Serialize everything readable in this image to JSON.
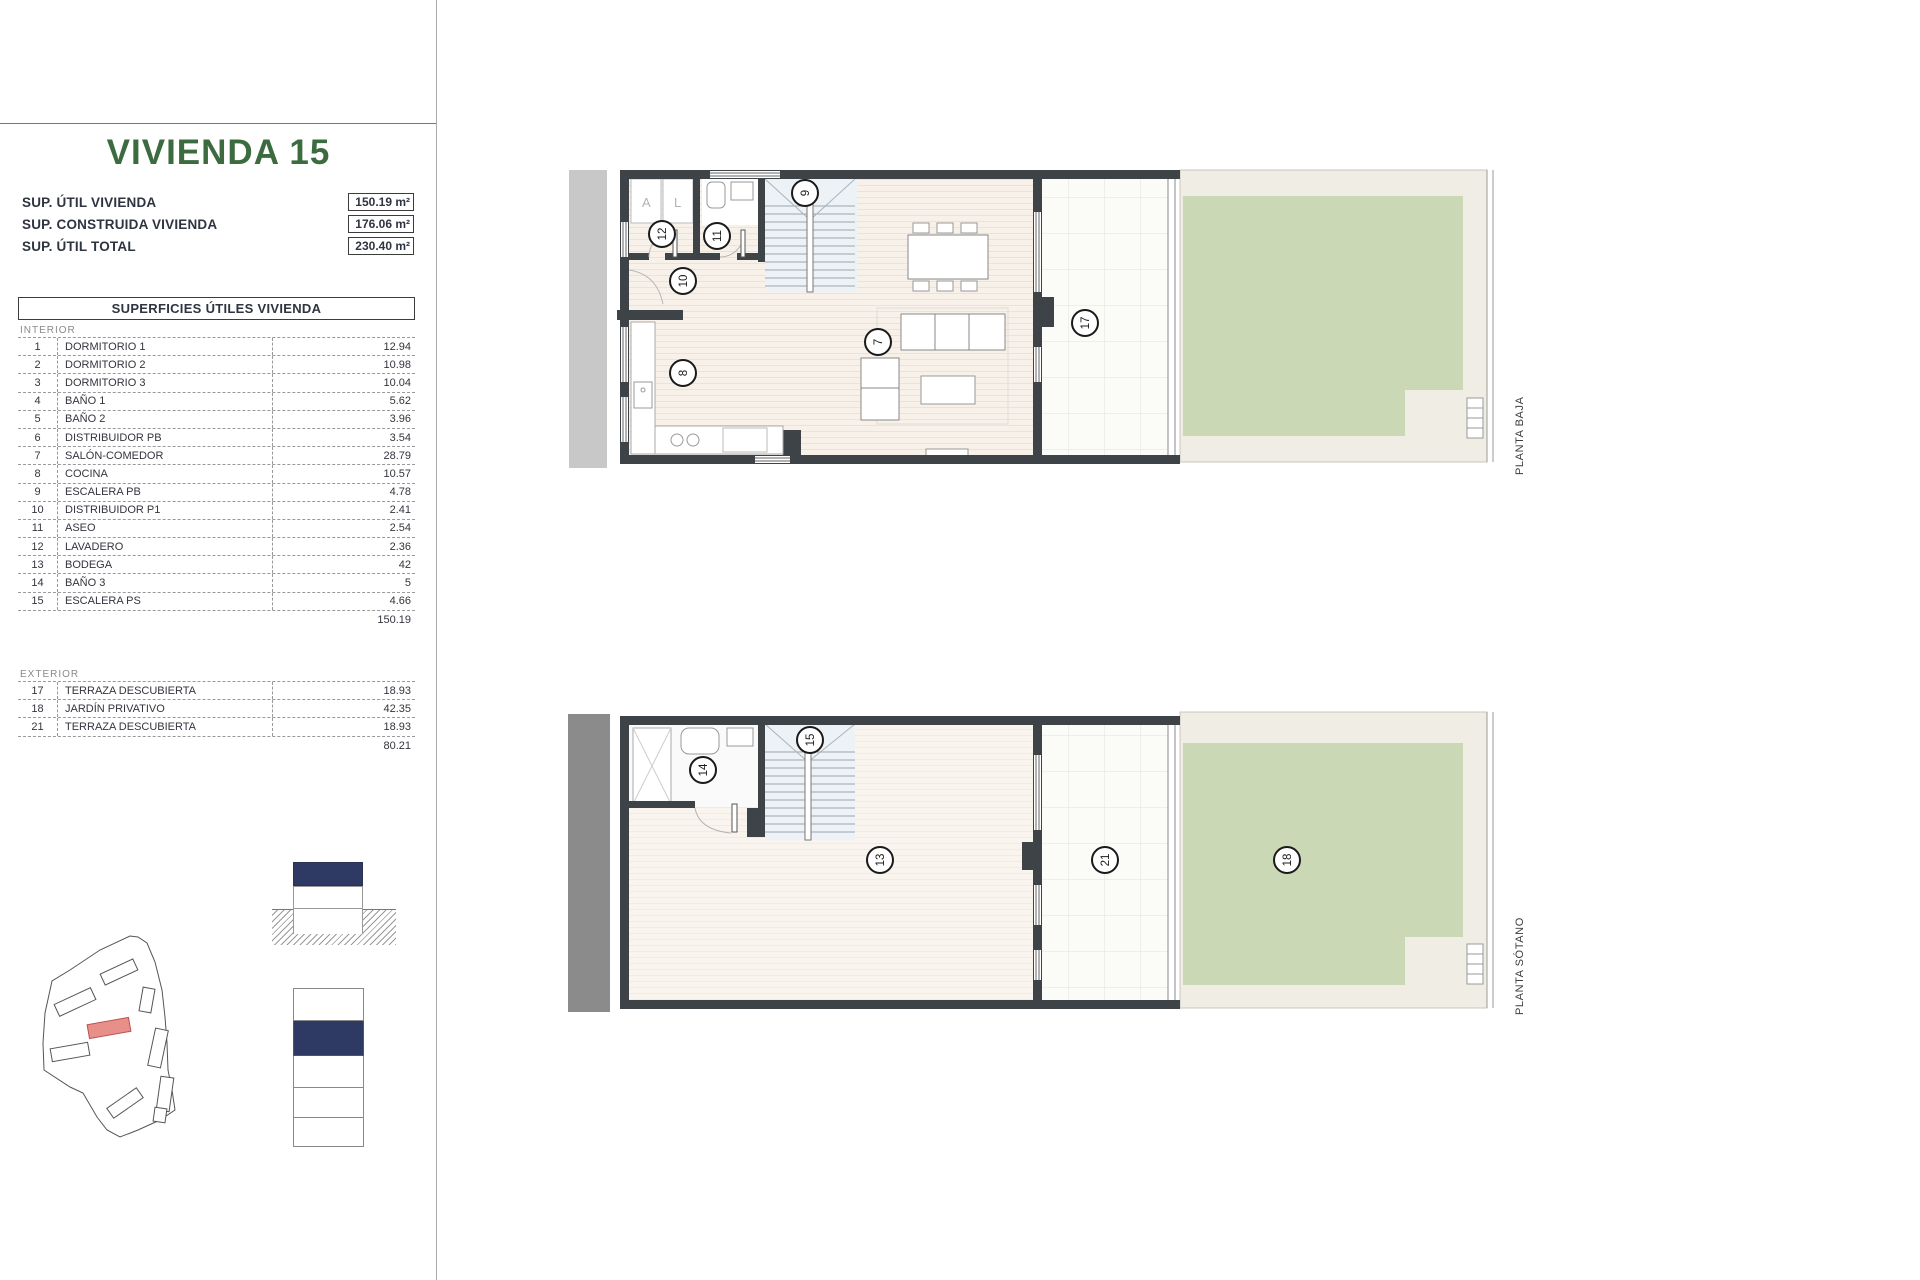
{
  "page": {
    "title": "VIVIENDA 15"
  },
  "summary": {
    "rows": [
      {
        "label": "SUP. ÚTIL VIVIENDA",
        "value": "150.19 m²"
      },
      {
        "label": "SUP. CONSTRUIDA VIVIENDA",
        "value": "176.06 m²"
      },
      {
        "label": "SUP. ÚTIL TOTAL",
        "value": "230.40 m²"
      }
    ]
  },
  "areas_table": {
    "header": "SUPERFICIES ÚTILES VIVIENDA",
    "interior_label": "INTERIOR",
    "interior_rows": [
      {
        "num": "1",
        "name": "DORMITORIO 1",
        "value": "12.94"
      },
      {
        "num": "2",
        "name": "DORMITORIO 2",
        "value": "10.98"
      },
      {
        "num": "3",
        "name": "DORMITORIO 3",
        "value": "10.04"
      },
      {
        "num": "4",
        "name": "BAÑO 1",
        "value": "5.62"
      },
      {
        "num": "5",
        "name": "BAÑO 2",
        "value": "3.96"
      },
      {
        "num": "6",
        "name": "DISTRIBUIDOR PB",
        "value": "3.54"
      },
      {
        "num": "7",
        "name": "SALÓN-COMEDOR",
        "value": "28.79"
      },
      {
        "num": "8",
        "name": "COCINA",
        "value": "10.57"
      },
      {
        "num": "9",
        "name": "ESCALERA PB",
        "value": "4.78"
      },
      {
        "num": "10",
        "name": "DISTRIBUIDOR P1",
        "value": "2.41"
      },
      {
        "num": "11",
        "name": "ASEO",
        "value": "2.54"
      },
      {
        "num": "12",
        "name": "LAVADERO",
        "value": "2.36"
      },
      {
        "num": "13",
        "name": "BODEGA",
        "value": "42"
      },
      {
        "num": "14",
        "name": "BAÑO 3",
        "value": "5"
      },
      {
        "num": "15",
        "name": "ESCALERA PS",
        "value": "4.66"
      }
    ],
    "interior_total": "150.19",
    "exterior_label": "EXTERIOR",
    "exterior_rows": [
      {
        "num": "17",
        "name": "TERRAZA DESCUBIERTA",
        "value": "18.93"
      },
      {
        "num": "18",
        "name": "JARDÍN PRIVATIVO",
        "value": "42.35"
      },
      {
        "num": "21",
        "name": "TERRAZA DESCUBIERTA",
        "value": "18.93"
      }
    ],
    "exterior_total": "80.21"
  },
  "plans": {
    "planta_baja": {
      "label": "PLANTA BAJA",
      "closets": [
        "A",
        "L"
      ],
      "circles": [
        "12",
        "11",
        "10",
        "9",
        "8",
        "7",
        "17"
      ]
    },
    "planta_sotano": {
      "label": "PLANTA SÓTANO",
      "circles": [
        "14",
        "15",
        "13",
        "21",
        "18"
      ]
    }
  },
  "colors": {
    "title_green": "#3d6b40",
    "unit_red": "#e98f8a",
    "navy": "#2e3a64",
    "garden_green": "#cbd8b5",
    "wall_dark": "#3e4347",
    "floor_cream": "#f8f1e9",
    "stair_blue": "#edf2f6",
    "terrace_white": "#fbfbf8",
    "walkway": "#f0eee4",
    "gray_band_light": "#c8c8c8",
    "gray_band_dark": "#8b8b8b"
  }
}
